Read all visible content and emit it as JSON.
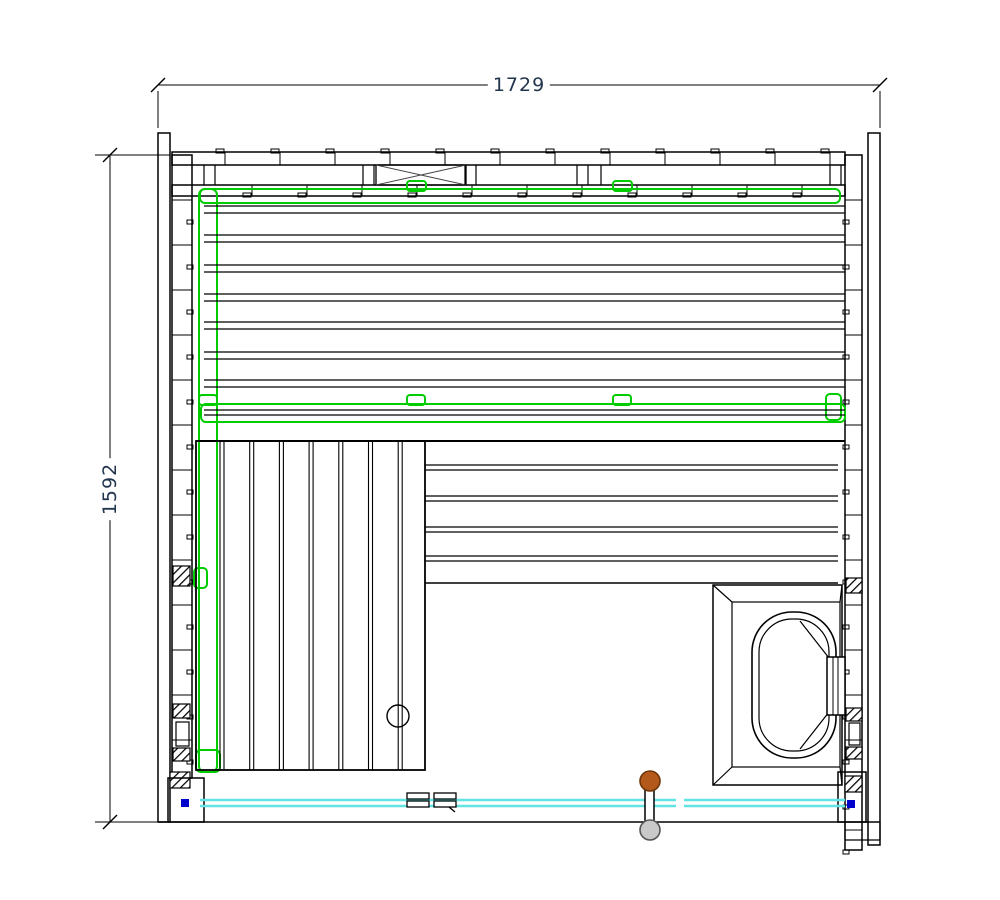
{
  "page": {
    "background": "#ffffff"
  },
  "dimensions": {
    "width": "1729",
    "height": "1592"
  },
  "colors": {
    "line": "#000000",
    "green_rail": "#00cc00",
    "glass_cyan": "#63e4e4",
    "anchor_blue": "#0000cc",
    "handle_brown": "#b3591c",
    "handle_gray": "#c9c9c9",
    "dim_text": "#22354e"
  },
  "drawing": {
    "canvas": {
      "width": 1000,
      "height": 900
    },
    "elements": [
      {
        "t": "line",
        "n": "dim-top-line",
        "x1": 158,
        "y1": 85,
        "x2": 880,
        "y2": 85,
        "sw": 1
      },
      {
        "t": "line",
        "n": "dim-tick",
        "x1": 151,
        "y1": 92,
        "x2": 165,
        "y2": 78,
        "sw": 1.4
      },
      {
        "t": "line",
        "n": "dim-tick",
        "x1": 873,
        "y1": 92,
        "x2": 887,
        "y2": 78,
        "sw": 1.4
      },
      {
        "t": "line",
        "n": "dim-ext",
        "x1": 158,
        "y1": 91,
        "x2": 158,
        "y2": 128,
        "sw": 1
      },
      {
        "t": "line",
        "n": "dim-ext",
        "x1": 880,
        "y1": 91,
        "x2": 880,
        "y2": 128,
        "sw": 1
      },
      {
        "t": "line",
        "n": "dim-left-line",
        "x1": 110,
        "y1": 155,
        "x2": 110,
        "y2": 822,
        "sw": 1
      },
      {
        "t": "line",
        "n": "dim-tick",
        "x1": 103,
        "y1": 162,
        "x2": 117,
        "y2": 148,
        "sw": 1.4
      },
      {
        "t": "line",
        "n": "dim-tick",
        "x1": 103,
        "y1": 829,
        "x2": 117,
        "y2": 815,
        "sw": 1.4
      },
      {
        "t": "line",
        "n": "dim-ext",
        "x1": 95,
        "y1": 155,
        "x2": 170,
        "y2": 155,
        "sw": 1
      },
      {
        "t": "line",
        "n": "dim-ext",
        "x1": 95,
        "y1": 822,
        "x2": 162,
        "y2": 822,
        "sw": 1
      },
      {
        "t": "rect",
        "n": "wall-left-outer",
        "x": 158,
        "y": 133,
        "w": 12,
        "h": 689,
        "sw": 1.5
      },
      {
        "t": "rect",
        "n": "wall-left-inner",
        "x": 172,
        "y": 155,
        "w": 20,
        "h": 623,
        "sw": 1.5
      },
      {
        "t": "rect",
        "n": "wall-right-outer",
        "x": 868,
        "y": 133,
        "w": 12,
        "h": 712,
        "sw": 1.5
      },
      {
        "t": "rect",
        "n": "wall-right-inner",
        "x": 845,
        "y": 155,
        "w": 17,
        "h": 695,
        "sw": 1.5
      },
      {
        "t": "rect",
        "n": "wall-top-row1",
        "x": 172,
        "y": 152,
        "w": 673,
        "h": 13,
        "sw": 1.5
      },
      {
        "t": "rect",
        "n": "wall-top-row2",
        "x": 172,
        "y": 185,
        "w": 673,
        "h": 11,
        "sw": 1.5
      },
      {
        "t": "rect",
        "n": "wall-top-xpanel",
        "x": 376,
        "y": 165,
        "w": 90,
        "h": 20,
        "sw": 1.3
      },
      {
        "t": "line",
        "n": "x-brace",
        "x1": 376,
        "y1": 165,
        "x2": 466,
        "y2": 185,
        "sw": 1,
        "c": "#444444"
      },
      {
        "t": "line",
        "n": "x-brace",
        "x1": 376,
        "y1": 185,
        "x2": 466,
        "y2": 165,
        "sw": 1,
        "c": "#444444"
      },
      {
        "t": "line",
        "n": "wall-stud",
        "x1": 204,
        "y1": 165,
        "x2": 204,
        "y2": 185,
        "sw": 1.2
      },
      {
        "t": "line",
        "n": "wall-stud",
        "x1": 215,
        "y1": 165,
        "x2": 215,
        "y2": 185,
        "sw": 1.2
      },
      {
        "t": "line",
        "n": "wall-stud",
        "x1": 363,
        "y1": 165,
        "x2": 363,
        "y2": 185,
        "sw": 1.2
      },
      {
        "t": "line",
        "n": "wall-stud",
        "x1": 374,
        "y1": 165,
        "x2": 374,
        "y2": 185,
        "sw": 1.2
      },
      {
        "t": "line",
        "n": "wall-stud",
        "x1": 465,
        "y1": 165,
        "x2": 465,
        "y2": 185,
        "sw": 1.2
      },
      {
        "t": "line",
        "n": "wall-stud",
        "x1": 476,
        "y1": 165,
        "x2": 476,
        "y2": 185,
        "sw": 1.2
      },
      {
        "t": "line",
        "n": "wall-stud",
        "x1": 577,
        "y1": 165,
        "x2": 577,
        "y2": 185,
        "sw": 1.2
      },
      {
        "t": "line",
        "n": "wall-stud",
        "x1": 588,
        "y1": 165,
        "x2": 588,
        "y2": 185,
        "sw": 1.2
      },
      {
        "t": "line",
        "n": "wall-stud",
        "x1": 601,
        "y1": 165,
        "x2": 601,
        "y2": 185,
        "sw": 1.2
      },
      {
        "t": "line",
        "n": "wall-stud",
        "x1": 830,
        "y1": 165,
        "x2": 830,
        "y2": 185,
        "sw": 1.2
      },
      {
        "t": "line",
        "n": "wall-stud",
        "x1": 841,
        "y1": 165,
        "x2": 841,
        "y2": 185,
        "sw": 1.2
      },
      {
        "t": "repeat",
        "n": "top-board-joints-outer",
        "nrep": 12,
        "dx": 55,
        "dy": 0,
        "items": [
          {
            "t": "line",
            "x1": 225,
            "y1": 152,
            "x2": 225,
            "y2": 165,
            "sw": 1
          },
          {
            "t": "rect",
            "x": 216,
            "y": 149,
            "w": 8,
            "h": 4,
            "sw": 1
          }
        ]
      },
      {
        "t": "repeat",
        "n": "top-board-joints-inner",
        "nrep": 11,
        "dx": 55,
        "dy": 0,
        "items": [
          {
            "t": "line",
            "x1": 252,
            "y1": 185,
            "x2": 252,
            "y2": 196,
            "sw": 1
          },
          {
            "t": "rect",
            "x": 243,
            "y": 193,
            "w": 8,
            "h": 4,
            "sw": 1
          }
        ]
      },
      {
        "t": "repeat",
        "n": "left-board-joints",
        "nrep": 13,
        "dx": 0,
        "dy": 45,
        "items": [
          {
            "t": "line",
            "x1": 172,
            "y1": 200,
            "x2": 192,
            "y2": 200,
            "sw": 1
          },
          {
            "t": "rect",
            "x": 187,
            "y": 220,
            "w": 6,
            "h": 4,
            "sw": 1
          }
        ]
      },
      {
        "t": "repeat",
        "n": "right-board-joints",
        "nrep": 15,
        "dx": 0,
        "dy": 45,
        "items": [
          {
            "t": "line",
            "x1": 845,
            "y1": 200,
            "x2": 862,
            "y2": 200,
            "sw": 1
          },
          {
            "t": "rect",
            "x": 843,
            "y": 220,
            "w": 6,
            "h": 4,
            "sw": 1
          }
        ]
      },
      {
        "t": "rect",
        "n": "insulation-hatch",
        "x": 173,
        "y": 566,
        "w": 17,
        "h": 20,
        "f": "hatch",
        "sw": 1.2
      },
      {
        "t": "rect",
        "n": "insulation-hatch",
        "x": 173,
        "y": 704,
        "w": 17,
        "h": 14,
        "f": "hatch",
        "sw": 1.2
      },
      {
        "t": "rect",
        "n": "vent-window",
        "x": 176,
        "y": 722,
        "w": 13,
        "h": 24,
        "sw": 1.2
      },
      {
        "t": "rect",
        "n": "insulation-hatch",
        "x": 173,
        "y": 748,
        "w": 17,
        "h": 13,
        "f": "hatch",
        "sw": 1.2
      },
      {
        "t": "rect",
        "n": "insulation-hatch",
        "x": 170,
        "y": 772,
        "w": 20,
        "h": 16,
        "f": "hatch",
        "sw": 1.2
      },
      {
        "t": "rect",
        "n": "corner-post-bl",
        "x": 168,
        "y": 778,
        "w": 36,
        "h": 44,
        "sw": 1.5
      },
      {
        "t": "rect",
        "n": "glass-anchor-blue",
        "x": 181,
        "y": 799,
        "w": 8,
        "h": 8,
        "f": "#0000cc",
        "sw": 0,
        "c": "none"
      },
      {
        "t": "rect",
        "n": "insulation-hatch",
        "x": 846,
        "y": 578,
        "w": 16,
        "h": 15,
        "f": "hatch",
        "sw": 1.2
      },
      {
        "t": "rect",
        "n": "insulation-hatch",
        "x": 846,
        "y": 708,
        "w": 16,
        "h": 13,
        "f": "hatch",
        "sw": 1.2
      },
      {
        "t": "rect",
        "n": "vent-window",
        "x": 849,
        "y": 723,
        "w": 11,
        "h": 22,
        "sw": 1.2
      },
      {
        "t": "rect",
        "n": "insulation-hatch",
        "x": 846,
        "y": 747,
        "w": 16,
        "h": 12,
        "f": "hatch",
        "sw": 1.2
      },
      {
        "t": "rect",
        "n": "insulation-hatch",
        "x": 845,
        "y": 776,
        "w": 17,
        "h": 16,
        "f": "hatch",
        "sw": 1.2
      },
      {
        "t": "rect",
        "n": "corner-post-br",
        "x": 838,
        "y": 772,
        "w": 28,
        "h": 50,
        "sw": 1.5
      },
      {
        "t": "rect",
        "n": "glass-anchor-blue",
        "x": 847,
        "y": 800,
        "w": 8,
        "h": 8,
        "f": "#0000cc",
        "sw": 0,
        "c": "none"
      },
      {
        "t": "line",
        "n": "wall-bottom-line",
        "x1": 158,
        "y1": 822,
        "x2": 880,
        "y2": 822,
        "sw": 1.5
      },
      {
        "t": "line",
        "n": "corner-step",
        "x1": 845,
        "y1": 822,
        "x2": 845,
        "y2": 840,
        "sw": 1.2
      },
      {
        "t": "line",
        "n": "corner-step",
        "x1": 880,
        "y1": 822,
        "x2": 880,
        "y2": 840,
        "sw": 1.2
      },
      {
        "t": "line",
        "n": "corner-step",
        "x1": 845,
        "y1": 840,
        "x2": 880,
        "y2": 840,
        "sw": 1.2
      },
      {
        "t": "rect",
        "n": "bench-rail-top",
        "x": 200,
        "y": 189,
        "w": 640,
        "h": 14,
        "rx": 5,
        "c": "#00cc00",
        "sw": 2
      },
      {
        "t": "rect",
        "n": "rail-clip",
        "x": 407,
        "y": 181,
        "w": 19,
        "h": 10,
        "rx": 3,
        "c": "#00cc00",
        "sw": 2
      },
      {
        "t": "rect",
        "n": "rail-clip",
        "x": 613,
        "y": 181,
        "w": 19,
        "h": 10,
        "rx": 3,
        "c": "#00cc00",
        "sw": 2
      },
      {
        "t": "rect",
        "n": "bench-rail-left",
        "x": 199,
        "y": 189,
        "w": 18,
        "h": 583,
        "rx": 6,
        "c": "#00cc00",
        "sw": 2
      },
      {
        "t": "rect",
        "n": "bench-rail-mid",
        "x": 201,
        "y": 404,
        "w": 644,
        "h": 18,
        "rx": 5,
        "c": "#00cc00",
        "sw": 2
      },
      {
        "t": "rect",
        "n": "rail-clip",
        "x": 199,
        "y": 395,
        "w": 18,
        "h": 10,
        "rx": 3,
        "c": "#00cc00",
        "sw": 2
      },
      {
        "t": "rect",
        "n": "rail-clip",
        "x": 407,
        "y": 395,
        "w": 18,
        "h": 10,
        "rx": 3,
        "c": "#00cc00",
        "sw": 2
      },
      {
        "t": "rect",
        "n": "rail-clip",
        "x": 613,
        "y": 395,
        "w": 18,
        "h": 10,
        "rx": 3,
        "c": "#00cc00",
        "sw": 2
      },
      {
        "t": "rect",
        "n": "rail-end",
        "x": 826,
        "y": 394,
        "w": 15,
        "h": 26,
        "rx": 4,
        "c": "#00cc00",
        "sw": 2
      },
      {
        "t": "rect",
        "n": "rail-clip",
        "x": 194,
        "y": 568,
        "w": 13,
        "h": 20,
        "rx": 4,
        "c": "#00cc00",
        "sw": 2
      },
      {
        "t": "rect",
        "n": "rail-end",
        "x": 196,
        "y": 750,
        "w": 24,
        "h": 22,
        "rx": 5,
        "c": "#00cc00",
        "sw": 2
      },
      {
        "t": "line",
        "n": "bench-front-edge",
        "x1": 196,
        "y1": 441,
        "x2": 845,
        "y2": 441,
        "sw": 2
      },
      {
        "t": "dline",
        "n": "bench-slat",
        "x1": 204,
        "y1": 206,
        "x2": 845,
        "y2": 206,
        "gap": 7,
        "sw": 1.2
      },
      {
        "t": "dline",
        "n": "bench-slat",
        "x1": 204,
        "y1": 235,
        "x2": 845,
        "y2": 235,
        "gap": 7,
        "sw": 1.2
      },
      {
        "t": "dline",
        "n": "bench-slat",
        "x1": 204,
        "y1": 265,
        "x2": 845,
        "y2": 265,
        "gap": 7,
        "sw": 1.2
      },
      {
        "t": "dline",
        "n": "bench-slat",
        "x1": 204,
        "y1": 294,
        "x2": 845,
        "y2": 294,
        "gap": 7,
        "sw": 1.2
      },
      {
        "t": "dline",
        "n": "bench-slat",
        "x1": 204,
        "y1": 322,
        "x2": 845,
        "y2": 322,
        "gap": 7,
        "sw": 1.2
      },
      {
        "t": "dline",
        "n": "bench-slat",
        "x1": 204,
        "y1": 352,
        "x2": 845,
        "y2": 352,
        "gap": 7,
        "sw": 1.2
      },
      {
        "t": "dline",
        "n": "bench-slat",
        "x1": 204,
        "y1": 380,
        "x2": 845,
        "y2": 380,
        "gap": 7,
        "sw": 1.2
      },
      {
        "t": "dline",
        "n": "bench-slat",
        "x1": 204,
        "y1": 410,
        "x2": 845,
        "y2": 410,
        "gap": 5,
        "sw": 1.2
      },
      {
        "t": "dline",
        "n": "bench-slat",
        "x1": 425,
        "y1": 465,
        "x2": 838,
        "y2": 465,
        "gap": 5,
        "sw": 1.2
      },
      {
        "t": "dline",
        "n": "bench-slat",
        "x1": 425,
        "y1": 496,
        "x2": 838,
        "y2": 496,
        "gap": 5,
        "sw": 1.2
      },
      {
        "t": "dline",
        "n": "bench-slat",
        "x1": 425,
        "y1": 527,
        "x2": 838,
        "y2": 527,
        "gap": 5,
        "sw": 1.2
      },
      {
        "t": "dline",
        "n": "bench-slat",
        "x1": 425,
        "y1": 556,
        "x2": 838,
        "y2": 556,
        "gap": 5,
        "sw": 1.2
      },
      {
        "t": "line",
        "n": "bench-low-edge",
        "x1": 425,
        "y1": 583,
        "x2": 838,
        "y2": 583,
        "sw": 1.5
      },
      {
        "t": "rect",
        "n": "bench-step",
        "x": 196,
        "y": 441,
        "w": 229,
        "h": 329,
        "sw": 1.8
      },
      {
        "t": "repeat",
        "n": "step-slats",
        "nrep": 7,
        "dx": 29.7,
        "dy": 0,
        "items": [
          {
            "t": "dline",
            "x1": 220,
            "y1": 441,
            "x2": 220,
            "y2": 770,
            "gap": 4,
            "sw": 1.1
          }
        ]
      },
      {
        "t": "circle",
        "n": "drain-circle",
        "cx": 398,
        "cy": 716,
        "r": 11,
        "sw": 1.4
      },
      {
        "t": "rect",
        "n": "heater-outer",
        "x": 713,
        "y": 585,
        "w": 129,
        "h": 200,
        "sw": 1.5
      },
      {
        "t": "rect",
        "n": "heater-inner",
        "x": 732,
        "y": 602,
        "w": 108,
        "h": 165,
        "sw": 1.2
      },
      {
        "t": "line",
        "n": "heater-bevel",
        "x1": 713,
        "y1": 585,
        "x2": 732,
        "y2": 602,
        "sw": 1.2
      },
      {
        "t": "line",
        "n": "heater-bevel",
        "x1": 842,
        "y1": 585,
        "x2": 840,
        "y2": 602,
        "sw": 1.2
      },
      {
        "t": "line",
        "n": "heater-bevel",
        "x1": 713,
        "y1": 785,
        "x2": 732,
        "y2": 767,
        "sw": 1.2
      },
      {
        "t": "line",
        "n": "heater-bevel",
        "x1": 842,
        "y1": 785,
        "x2": 840,
        "y2": 767,
        "sw": 1.2
      },
      {
        "t": "rect",
        "n": "heater-body-outer",
        "x": 752,
        "y": 612,
        "w": 84,
        "h": 146,
        "rx": 40,
        "sw": 1.6
      },
      {
        "t": "rect",
        "n": "heater-body-inner",
        "x": 759,
        "y": 619,
        "w": 70,
        "h": 132,
        "rx": 33,
        "sw": 1.2
      },
      {
        "t": "line",
        "n": "heater-chamfer",
        "x1": 800,
        "y1": 621,
        "x2": 829,
        "y2": 658,
        "sw": 1.2
      },
      {
        "t": "line",
        "n": "heater-chamfer",
        "x1": 800,
        "y1": 749,
        "x2": 829,
        "y2": 712,
        "sw": 1.2
      },
      {
        "t": "rect",
        "n": "heater-bracket",
        "x": 827,
        "y": 657,
        "w": 18,
        "h": 58,
        "f": "#ffffff",
        "sw": 1.5
      },
      {
        "t": "line",
        "n": "heater-bracket-line",
        "x1": 833,
        "y1": 657,
        "x2": 833,
        "y2": 715,
        "sw": 1
      },
      {
        "t": "line",
        "n": "heater-bracket-line",
        "x1": 838,
        "y1": 657,
        "x2": 838,
        "y2": 715,
        "sw": 1
      },
      {
        "t": "line",
        "n": "glass-front",
        "x1": 200,
        "y1": 800,
        "x2": 676,
        "y2": 800,
        "c": "#63e4e4",
        "sw": 2.6
      },
      {
        "t": "line",
        "n": "glass-front",
        "x1": 200,
        "y1": 806,
        "x2": 676,
        "y2": 806,
        "c": "#63e4e4",
        "sw": 2.6
      },
      {
        "t": "line",
        "n": "glass-door",
        "x1": 684,
        "y1": 800,
        "x2": 845,
        "y2": 800,
        "c": "#63e4e4",
        "sw": 2.6
      },
      {
        "t": "line",
        "n": "glass-door",
        "x1": 684,
        "y1": 806,
        "x2": 845,
        "y2": 806,
        "c": "#63e4e4",
        "sw": 2.6
      },
      {
        "t": "rect",
        "n": "door-hinge",
        "x": 407,
        "y": 793,
        "w": 22,
        "h": 6,
        "f": "#ffffff",
        "sw": 1.3
      },
      {
        "t": "rect",
        "n": "door-hinge",
        "x": 407,
        "y": 801,
        "w": 22,
        "h": 6,
        "f": "#ffffff",
        "sw": 1.3
      },
      {
        "t": "rect",
        "n": "door-hinge",
        "x": 434,
        "y": 793,
        "w": 22,
        "h": 6,
        "f": "#ffffff",
        "sw": 1.3
      },
      {
        "t": "rect",
        "n": "door-hinge",
        "x": 434,
        "y": 801,
        "w": 22,
        "h": 6,
        "f": "#ffffff",
        "sw": 1.3
      },
      {
        "t": "line",
        "n": "hinge-hook",
        "x1": 449,
        "y1": 807,
        "x2": 455,
        "y2": 812,
        "sw": 1.4
      },
      {
        "t": "rect",
        "n": "door-handle-stem",
        "x": 645,
        "y": 790,
        "w": 9,
        "h": 40,
        "f": "#ffffff",
        "sw": 1.5
      },
      {
        "t": "circle",
        "n": "door-handle-knob-inside",
        "cx": 650,
        "cy": 781,
        "r": 10,
        "f": "#b3591c",
        "c": "#6e3508",
        "sw": 1.6
      },
      {
        "t": "circle",
        "n": "door-handle-knob-outside",
        "cx": 650,
        "cy": 830,
        "r": 10,
        "f": "#c9c9c9",
        "c": "#555555",
        "sw": 1.6
      }
    ]
  }
}
